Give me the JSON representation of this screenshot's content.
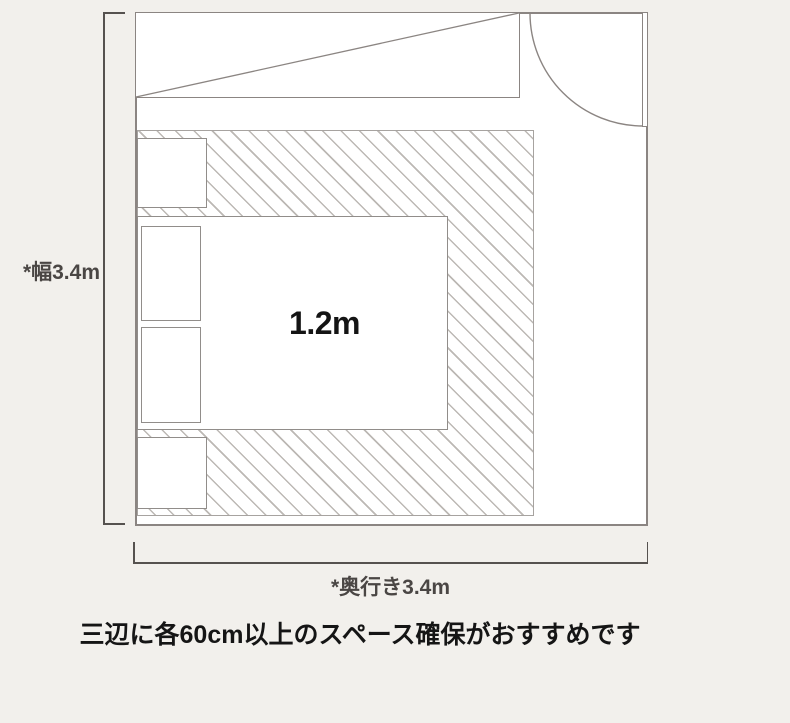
{
  "diagram": {
    "kind": "bedroom-furniture-layout-floor-plan",
    "bed": {
      "size_label": "1.2m"
    },
    "dimensions": {
      "width_label": "*幅3.4m",
      "depth_label": "*奥行き3.4m"
    },
    "caption": "三辺に各60cm以上のスペース確保がおすすめです",
    "elements": [
      "room-outline",
      "closet-with-diagonal",
      "swing-door",
      "clearance-hatch-zone",
      "bed",
      "pillow-top",
      "pillow-bottom",
      "nightstand-top",
      "nightstand-bottom"
    ]
  },
  "colors": {
    "background": "#f2f0ec",
    "room_fill": "#ffffff",
    "wall_line": "#8b8582",
    "furniture_line": "#918d8a",
    "hatch_line": "#bcb8b4",
    "hatch_border": "#a7a3a0",
    "dimension_line": "#56524f",
    "dimension_text": "#4a4644",
    "caption_text": "#151515"
  }
}
